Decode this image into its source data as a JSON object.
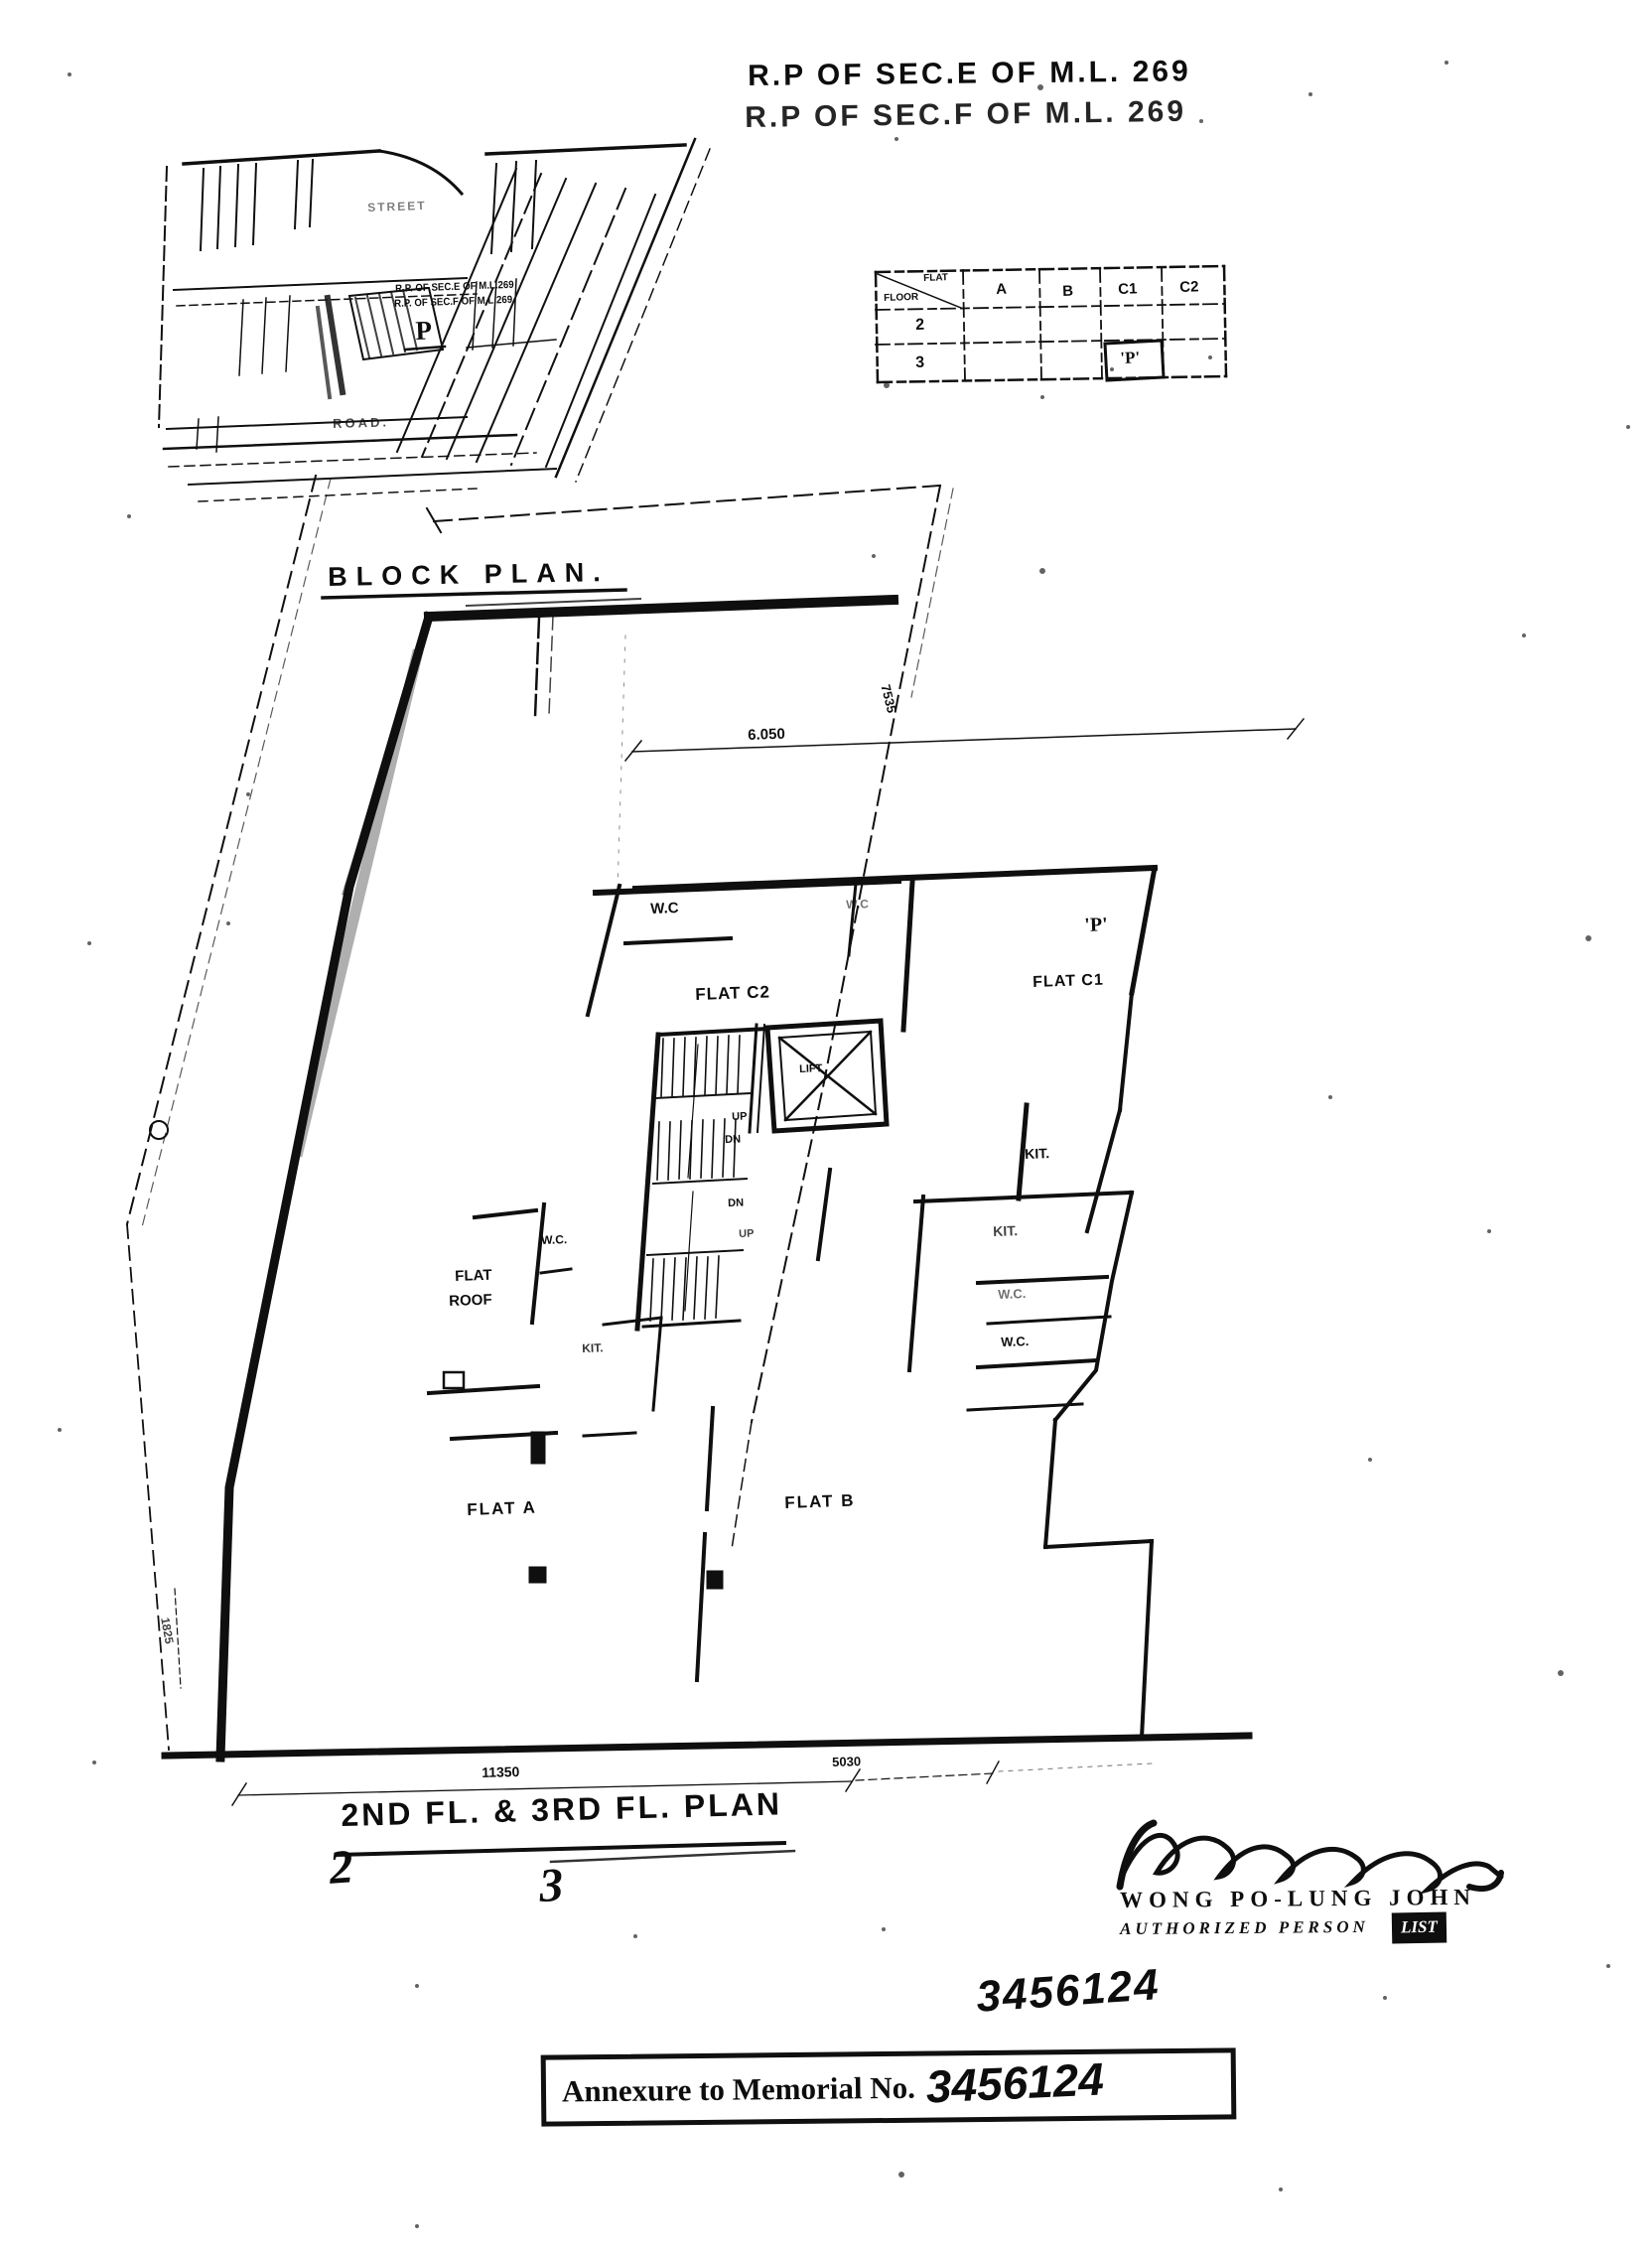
{
  "header": {
    "line1": "R.P OF SEC.E OF M.L. 269",
    "line2": "R.P OF SEC.F OF M.L. 269"
  },
  "block_plan": {
    "title": "BLOCK PLAN.",
    "street": "STREET",
    "road": "ROAD.",
    "lot_line1": "R.P. OF SEC.E OF M.L.269",
    "lot_line2": "R.P. OF SEC.F OF M.L.269",
    "p_marker": "P"
  },
  "flat_table": {
    "corner_flat": "FLAT",
    "corner_floor": "FLOOR",
    "columns": [
      "A",
      "B",
      "C1",
      "C2"
    ],
    "floors": [
      "2",
      "3"
    ],
    "p_cell": "'P'"
  },
  "floor_plan": {
    "rooms": {
      "wc_c2": "W.C",
      "wc_mid": "W.C",
      "flat_c2": "FLAT C2",
      "p": "'P'",
      "flat_c1": "FLAT C1",
      "lift": "LIFT",
      "up1": "UP",
      "dn1": "DN",
      "dn2": "DN",
      "up2": "UP",
      "kit1": "KIT.",
      "kit2": "KIT.",
      "wc_r1": "W.C.",
      "wc_r2": "W.C.",
      "wc_c": "W.C.",
      "kit3": "KIT.",
      "flat_roof1": "FLAT",
      "flat_roof2": "ROOF",
      "flat_a": "FLAT A",
      "flat_b": "FLAT B"
    },
    "dims": {
      "top": "6.050",
      "right": "7535",
      "bottom_left": "11350",
      "bottom_right": "5030",
      "left": "1825"
    }
  },
  "plan_title": {
    "text": "2ND FL. & 3RD FL. PLAN",
    "hand2": "2",
    "hand3": "3"
  },
  "signature": {
    "name": "WONG PO-LUNG JOHN",
    "role": "AUTHORIZED PERSON",
    "role_box": "LIST"
  },
  "memorial": {
    "hand_number": "3456124",
    "stamp_label": "Annexure to Memorial No.",
    "stamp_number": "3456124"
  }
}
